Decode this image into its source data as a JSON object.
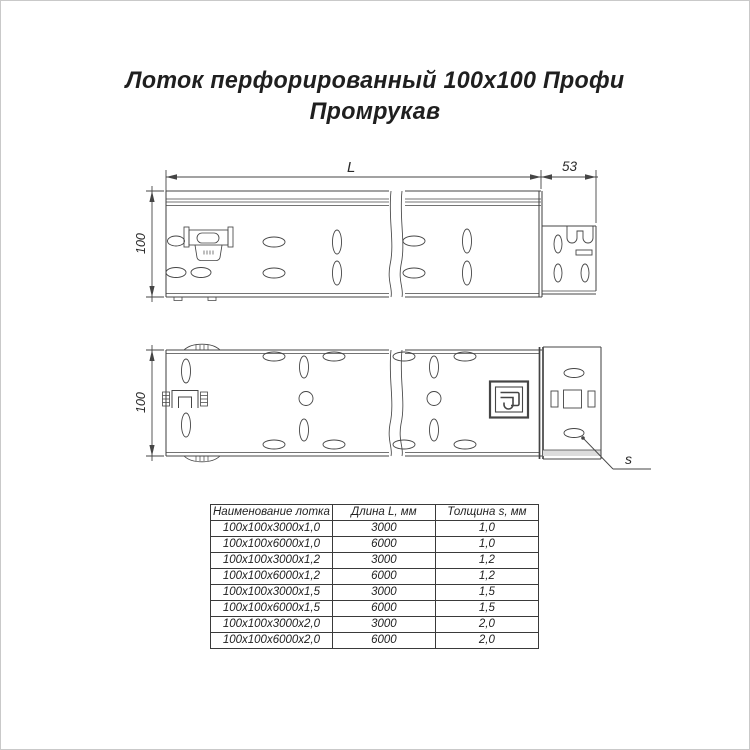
{
  "title": {
    "line1": "Лоток перфорированный 100х100 Профи",
    "line2": "Промрукав"
  },
  "dims": {
    "length_label": "L",
    "end_width_label": "53",
    "height_side_label": "100",
    "height_plan_label": "100",
    "thickness_label": "s"
  },
  "drawing": {
    "line_color": "#454545",
    "views": [
      "side-elevation",
      "plan-view"
    ],
    "features": [
      "perforation-slots",
      "ground-clamp",
      "break-lines",
      "end-connector",
      "promrukav-logo-stamp"
    ]
  },
  "table": {
    "headers": [
      "Наименование лотка",
      "Длина L, мм",
      "Толщина s, мм"
    ],
    "rows": [
      {
        "name": "100х100х3000х1,0",
        "length": "3000",
        "thickness": "1,0"
      },
      {
        "name": "100х100х6000х1,0",
        "length": "6000",
        "thickness": "1,0"
      },
      {
        "name": "100х100х3000х1,2",
        "length": "3000",
        "thickness": "1,2"
      },
      {
        "name": "100х100х6000х1,2",
        "length": "6000",
        "thickness": "1,2"
      },
      {
        "name": "100х100х3000х1,5",
        "length": "3000",
        "thickness": "1,5"
      },
      {
        "name": "100х100х6000х1,5",
        "length": "6000",
        "thickness": "1,5"
      },
      {
        "name": "100х100х3000х2,0",
        "length": "3000",
        "thickness": "2,0"
      },
      {
        "name": "100х100х6000х2,0",
        "length": "6000",
        "thickness": "2,0"
      }
    ]
  }
}
